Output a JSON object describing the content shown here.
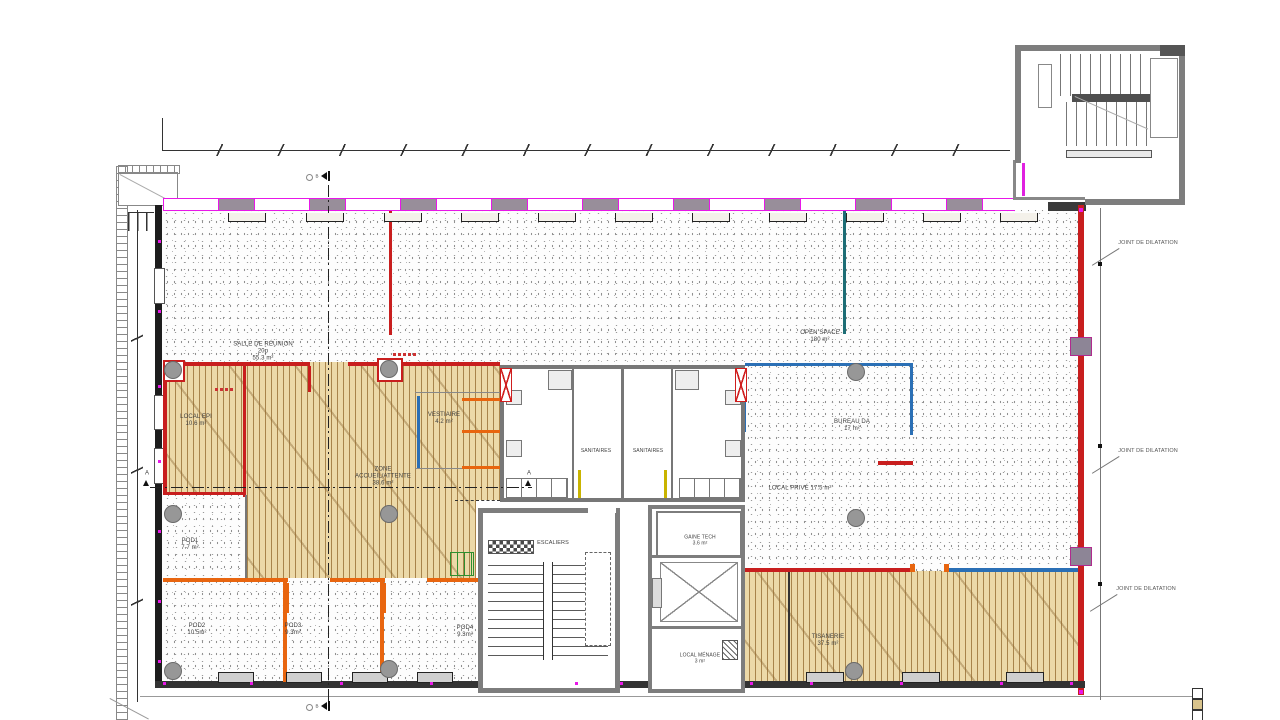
{
  "plan": {
    "rooms": {
      "salle_reunion": {
        "name": "SALLE DE RÉUNION",
        "capacity": "20p",
        "area": "55.3 m²"
      },
      "open_space": {
        "name": "OPEN SPACE",
        "area": "180 m²"
      },
      "bureau_da": {
        "name": "BUREAU DA",
        "area": "17 m²"
      },
      "local_prive": {
        "label": "LOCAL PRIVÉ 17.5 m²"
      },
      "zone_accueil": {
        "line1": "ZONE",
        "line2": "ACCUEIL/ATTENTE",
        "area": "38.6 m²"
      },
      "local_epi": {
        "name": "LOCAL EPI",
        "area": "10.6 m²"
      },
      "vestiaire": {
        "name": "VESTIAIRE",
        "area": "4.2 m²"
      },
      "pod1": {
        "name": "POD1",
        "area": "7.7 m²"
      },
      "pod2": {
        "name": "POD2",
        "area": "10.5m²"
      },
      "pod3": {
        "name": "POD3",
        "area": "9.3m²"
      },
      "pod4": {
        "name": "POD4",
        "area": "9.3m²"
      },
      "sanitaires_left": {
        "name": "SANITAIRES"
      },
      "sanitaires_right": {
        "name": "SANITAIRES"
      },
      "escaliers": {
        "name": "ESCALIERS"
      },
      "gaine_tech": {
        "name": "GAINE TECH",
        "area": "3.6 m²"
      },
      "local_menage": {
        "name": "LOCAL MÉNAGE",
        "area": "3 m²"
      },
      "tisanerie": {
        "name": "TISANERIE",
        "area": "37.5 m²"
      }
    },
    "annotations": {
      "joint_dilatation": "JOINT DE DILATATION",
      "section_a": "A",
      "section_b": "B"
    },
    "colors": {
      "facade_magenta": "#e817e8",
      "wall_red": "#c4201c",
      "wall_blue": "#2a6fb5",
      "wall_orange": "#e8650f",
      "partition_teal": "#1d6d75",
      "wood_floor": "#ecd9a8"
    }
  }
}
